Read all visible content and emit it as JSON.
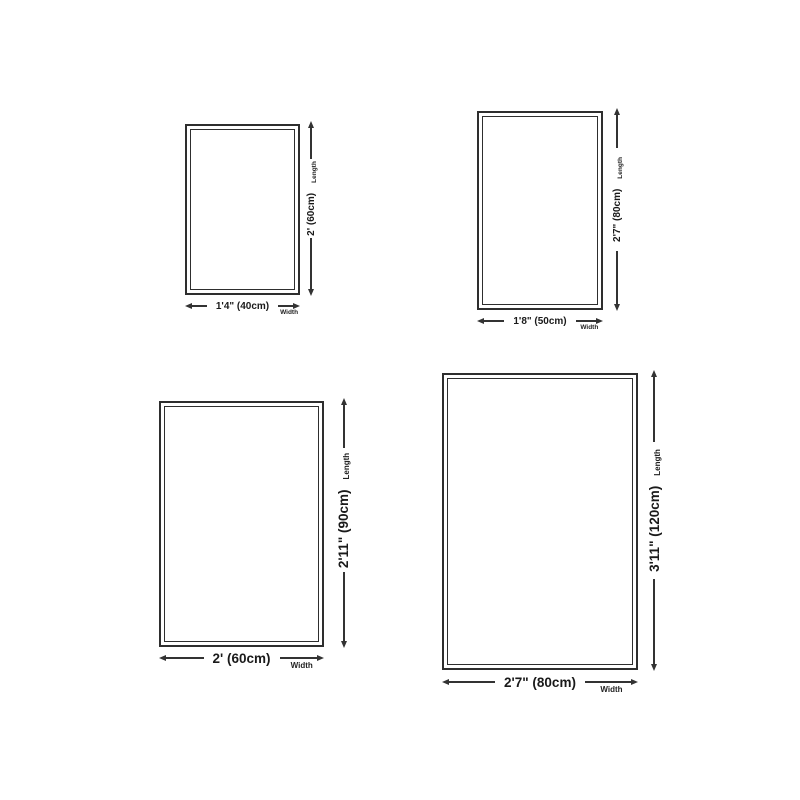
{
  "colors": {
    "background": "#ffffff",
    "line": "#333333",
    "text": "#1a1a1a"
  },
  "rugs": [
    {
      "width_label": "1'4\" (40cm)",
      "length_label": "2' (60cm)",
      "width_axis": "Width",
      "length_axis": "Length"
    },
    {
      "width_label": "1'8\" (50cm)",
      "length_label": "2'7\" (80cm)",
      "width_axis": "Width",
      "length_axis": "Length"
    },
    {
      "width_label": "2' (60cm)",
      "length_label": "2'11\" (90cm)",
      "width_axis": "Width",
      "length_axis": "Length"
    },
    {
      "width_label": "2'7\" (80cm)",
      "length_label": "3'11\" (120cm)",
      "width_axis": "Width",
      "length_axis": "Length"
    }
  ]
}
